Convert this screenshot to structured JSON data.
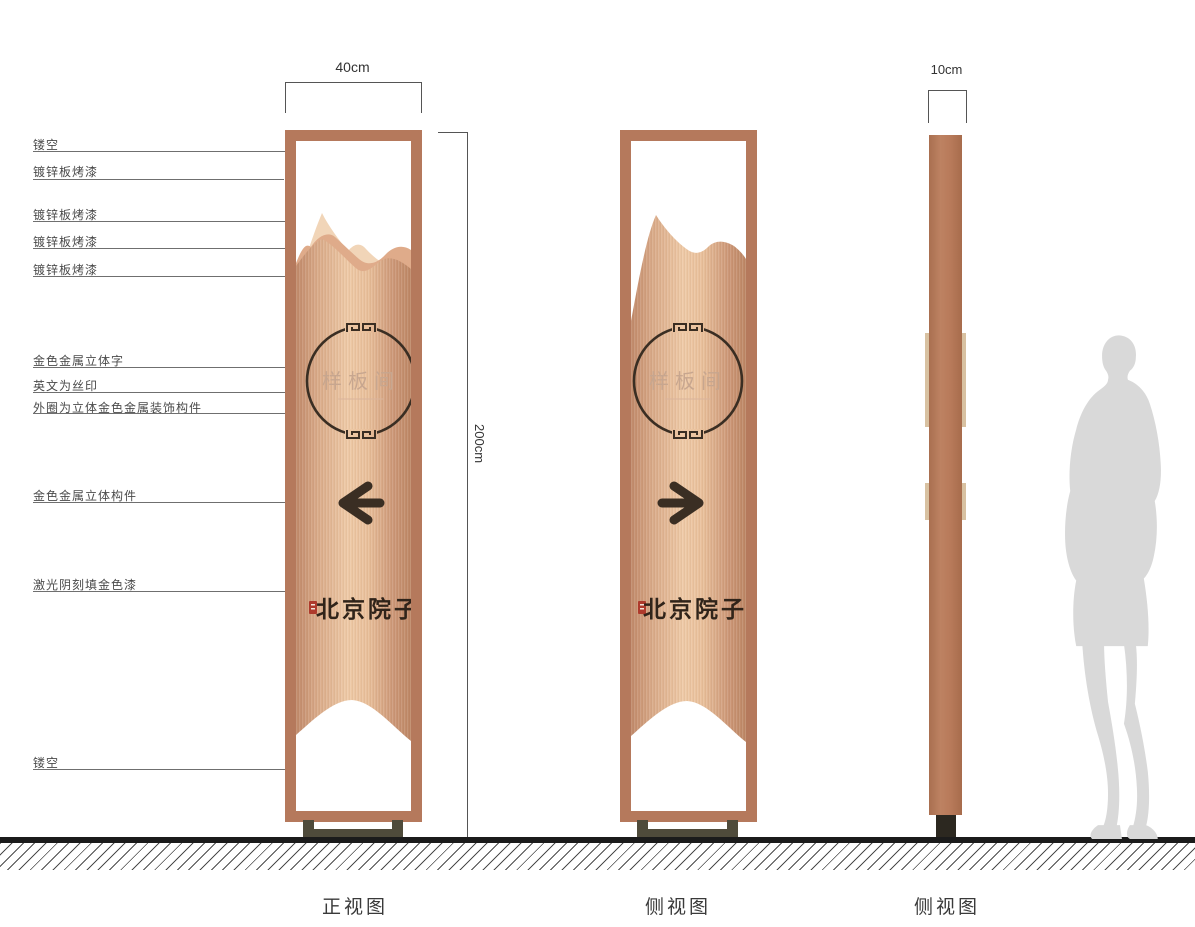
{
  "callouts": [
    {
      "id": "hollow-top",
      "label": "镂空"
    },
    {
      "id": "galvanized-1",
      "label": "镀锌板烤漆"
    },
    {
      "id": "galvanized-2",
      "label": "镀锌板烤漆"
    },
    {
      "id": "galvanized-3",
      "label": "镀锌板烤漆"
    },
    {
      "id": "galvanized-4",
      "label": "镀锌板烤漆"
    },
    {
      "id": "gold-3d-letters",
      "label": "金色金属立体字"
    },
    {
      "id": "english-silkscreen",
      "label": "英文为丝印"
    },
    {
      "id": "outer-ring",
      "label": "外圈为立体金色金属装饰构件"
    },
    {
      "id": "gold-3d-component",
      "label": "金色金属立体构件"
    },
    {
      "id": "laser-engraved",
      "label": "激光阴刻填金色漆"
    },
    {
      "id": "hollow-bottom",
      "label": "镂空"
    }
  ],
  "dimensions": {
    "front_width": "40cm",
    "height": "200cm",
    "side_width": "10cm"
  },
  "sign": {
    "emblem_text": "样板间",
    "brand_text": "北京院子"
  },
  "views": {
    "front": "正视图",
    "side": "侧视图",
    "profile": "侧视图"
  },
  "colors": {
    "frame": "#b5795c",
    "copper_light": "#eec9a6",
    "copper_dark": "#c0896a",
    "accent_dark": "#3a2e23",
    "seal_red": "#ae3a2c",
    "base": "#4f4b3b",
    "silhouette": "#d9d9d9"
  }
}
